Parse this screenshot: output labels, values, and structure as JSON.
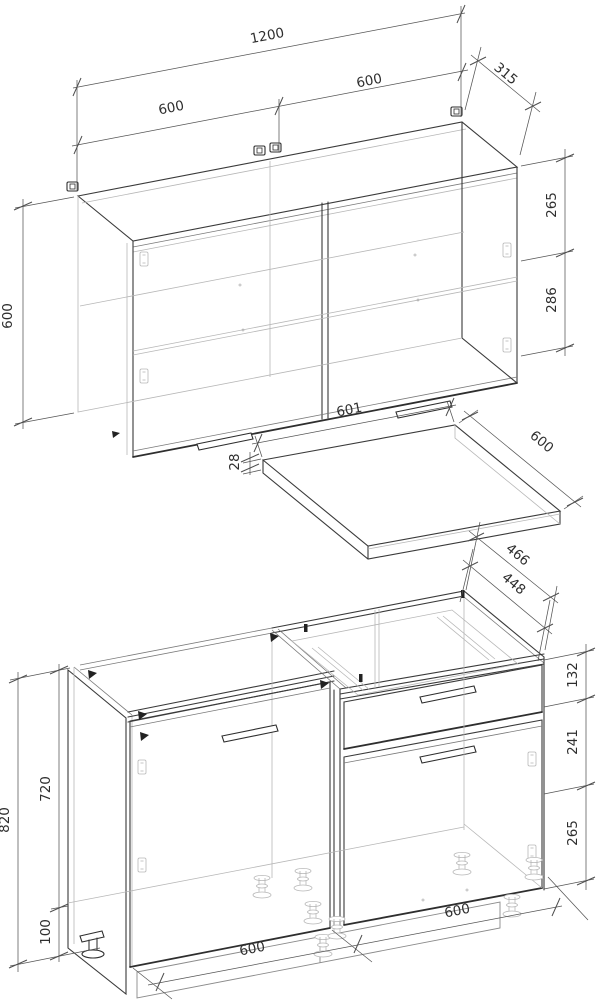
{
  "drawing": {
    "background": "#ffffff",
    "stroke_main": "#3a3a3a",
    "stroke_light": "#b7b7b7",
    "stroke_dim": "#555555",
    "wall_cabinet": {
      "dims": {
        "total_width": "1200",
        "left_door_width": "600",
        "right_door_width": "600",
        "depth": "315",
        "height": "600",
        "hinge_top_offset": "265",
        "hinge_spacing": "286"
      }
    },
    "countertop": {
      "dims": {
        "width": "601",
        "depth": "600",
        "thickness": "28"
      }
    },
    "base_cabinet": {
      "dims": {
        "top_depth_outer": "466",
        "top_depth_inner": "448",
        "drawer_front_height": "132",
        "middle_height": "241",
        "lower_height": "265",
        "total_height": "820",
        "body_height": "720",
        "leg_height": "100",
        "left_section_width": "600",
        "right_section_width": "600"
      }
    }
  }
}
